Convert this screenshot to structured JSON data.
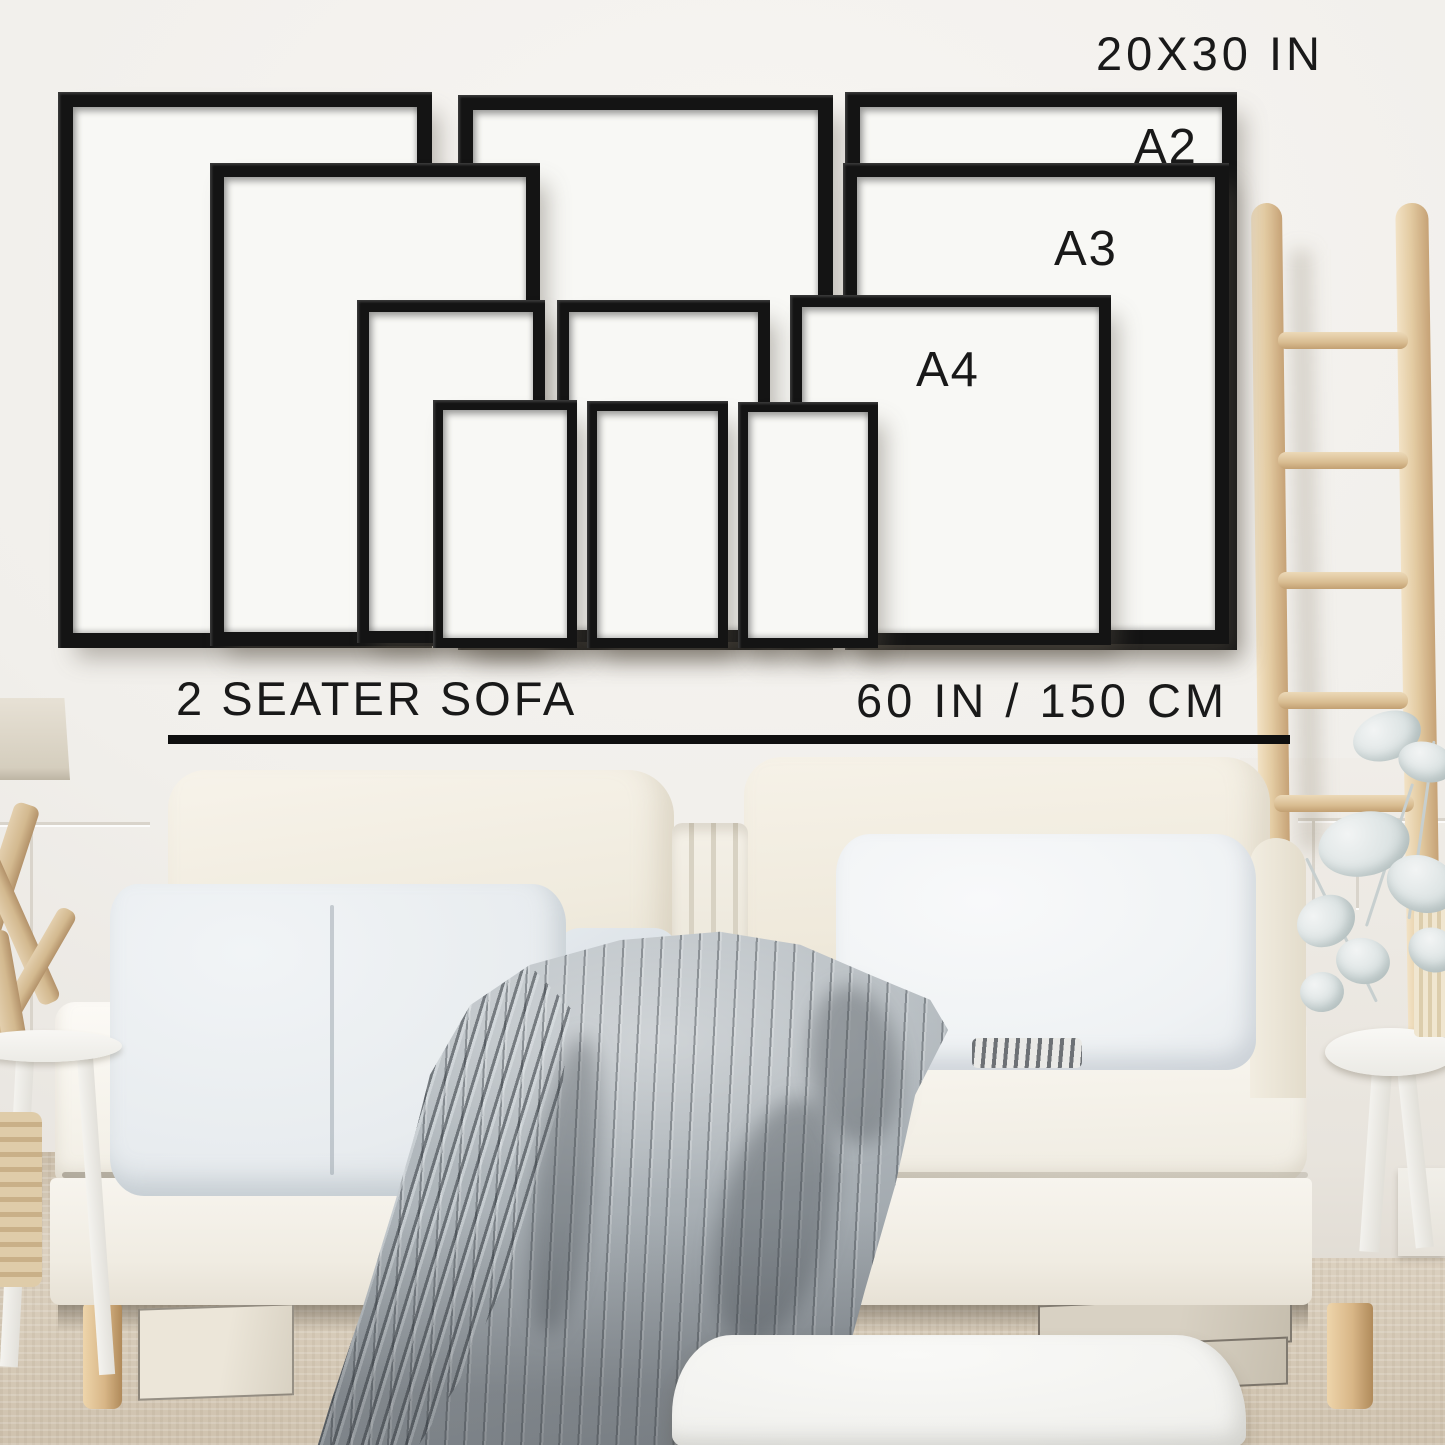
{
  "scene": {
    "type": "wall-art-size-guide-photo",
    "labels": {
      "top_size": "20X30 IN",
      "a2": "A2",
      "a3": "A3",
      "a4": "A4",
      "sofa": "2 SEATER SOFA",
      "sofa_width": "60 IN / 150 CM"
    },
    "colors": {
      "frame_black": "#141414",
      "text": "#1a1a1a",
      "wall": "#f1efeb",
      "floor_carpet": "#d5c9b6",
      "ladder_wood": "#e0c79e",
      "blanket_grey": "#aeb5ba",
      "cushion_cream": "#f3efe4"
    },
    "frames": [
      {
        "id": "frame-20x30-left",
        "size": "20X30 IN",
        "x": 58,
        "y": 92,
        "w": 374,
        "h": 556,
        "border": 15
      },
      {
        "id": "frame-20x30-middle",
        "size": "20X30 IN",
        "x": 458,
        "y": 95,
        "w": 375,
        "h": 555,
        "border": 15
      },
      {
        "id": "frame-20x30-right",
        "size": "20X30 IN",
        "x": 845,
        "y": 92,
        "w": 392,
        "h": 558,
        "border": 15
      },
      {
        "id": "frame-a2-left",
        "size": "A2",
        "x": 210,
        "y": 163,
        "w": 330,
        "h": 483,
        "border": 14
      },
      {
        "id": "frame-a2-right",
        "size": "A2",
        "x": 843,
        "y": 163,
        "w": 386,
        "h": 481,
        "border": 14
      },
      {
        "id": "frame-a3-left",
        "size": "A3",
        "x": 357,
        "y": 300,
        "w": 188,
        "h": 343,
        "border": 12
      },
      {
        "id": "frame-a3-middle",
        "size": "A3",
        "x": 557,
        "y": 300,
        "w": 213,
        "h": 342,
        "border": 12
      },
      {
        "id": "frame-a3-right",
        "size": "A3",
        "x": 790,
        "y": 295,
        "w": 321,
        "h": 350,
        "border": 12
      },
      {
        "id": "frame-a4-left",
        "size": "A4",
        "x": 433,
        "y": 400,
        "w": 144,
        "h": 248,
        "border": 10
      },
      {
        "id": "frame-a4-middle",
        "size": "A4",
        "x": 587,
        "y": 401,
        "w": 141,
        "h": 247,
        "border": 10
      },
      {
        "id": "frame-a4-right",
        "size": "A4",
        "x": 738,
        "y": 402,
        "w": 140,
        "h": 246,
        "border": 10
      }
    ]
  }
}
